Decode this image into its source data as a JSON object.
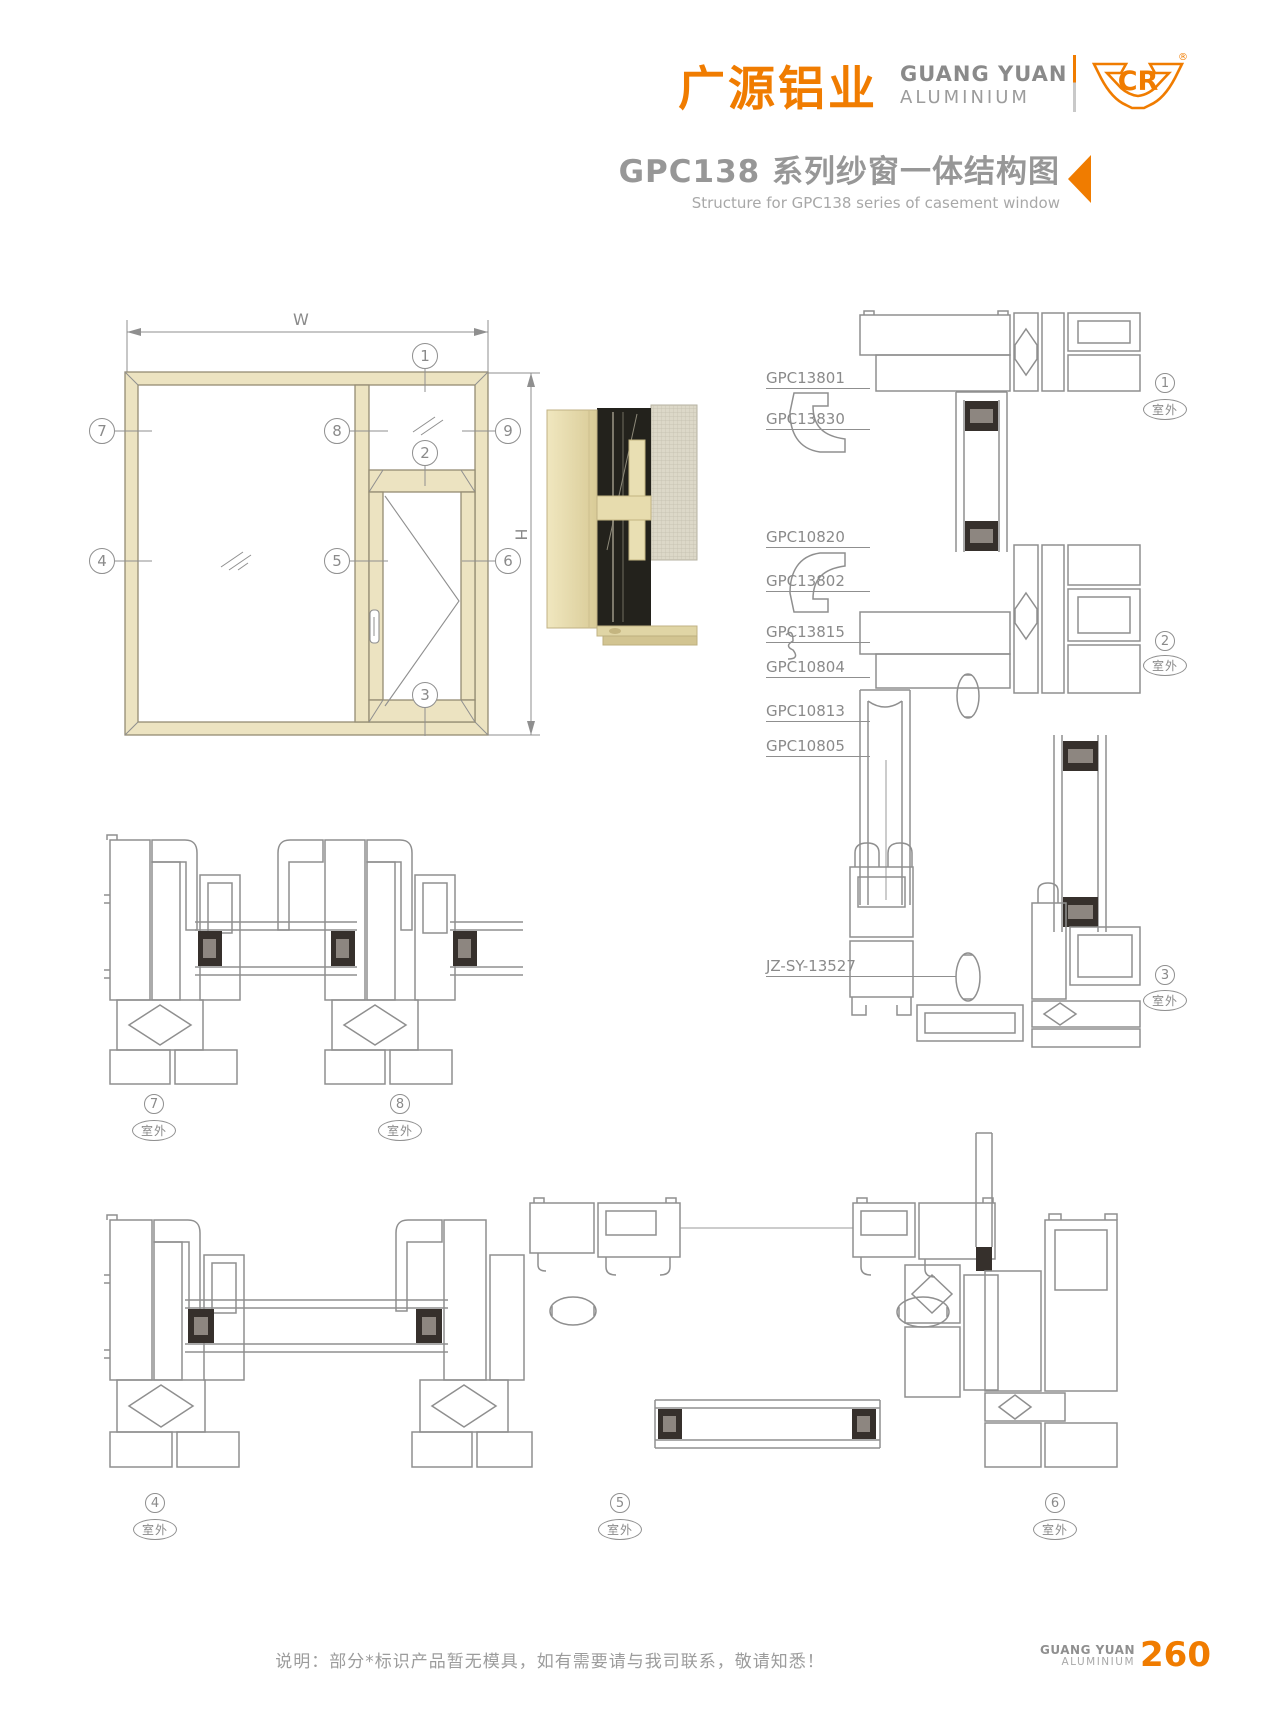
{
  "header": {
    "logo_cn": "广源铝业",
    "logo_en1": "GUANG YUAN",
    "logo_en2": "ALUMINIUM",
    "emblem_text": "CR",
    "registered": "®",
    "title_cn": "GPC138 系列纱窗一体结构图",
    "title_en": "Structure for GPC138 series of casement window"
  },
  "elevation": {
    "dim_w": "W",
    "dim_h": "H",
    "callouts": {
      "c1": "1",
      "c2": "2",
      "c3": "3",
      "c4": "4",
      "c5": "5",
      "c6": "6",
      "c7": "7",
      "c8": "8",
      "c9": "9"
    }
  },
  "part_labels": {
    "l1": "GPC13801",
    "l2": "GPC13830",
    "l3": "GPC10820",
    "l4": "GPC13802",
    "l5": "GPC13815",
    "l6": "GPC10804",
    "l7": "GPC10813",
    "l8": "GPC10805",
    "l9": "JZ-SY-13527"
  },
  "details": {
    "outdoor": "室外",
    "d1": "1",
    "d2": "2",
    "d3": "3",
    "d4": "4",
    "d5": "5",
    "d6": "6",
    "d7": "7",
    "d8": "8"
  },
  "footer": {
    "note": "说明：部分*标识产品暂无模具，如有需要请与我司联系，敬请知悉！",
    "brand1": "GUANG YUAN",
    "brand2": "ALUMINIUM",
    "page": "260"
  },
  "colors": {
    "accent": "#f07c00",
    "line_gray": "#8f8f8f",
    "text_gray": "#979797",
    "frame_beige": "#ece3c1",
    "glazing_dark": "#36302c"
  }
}
